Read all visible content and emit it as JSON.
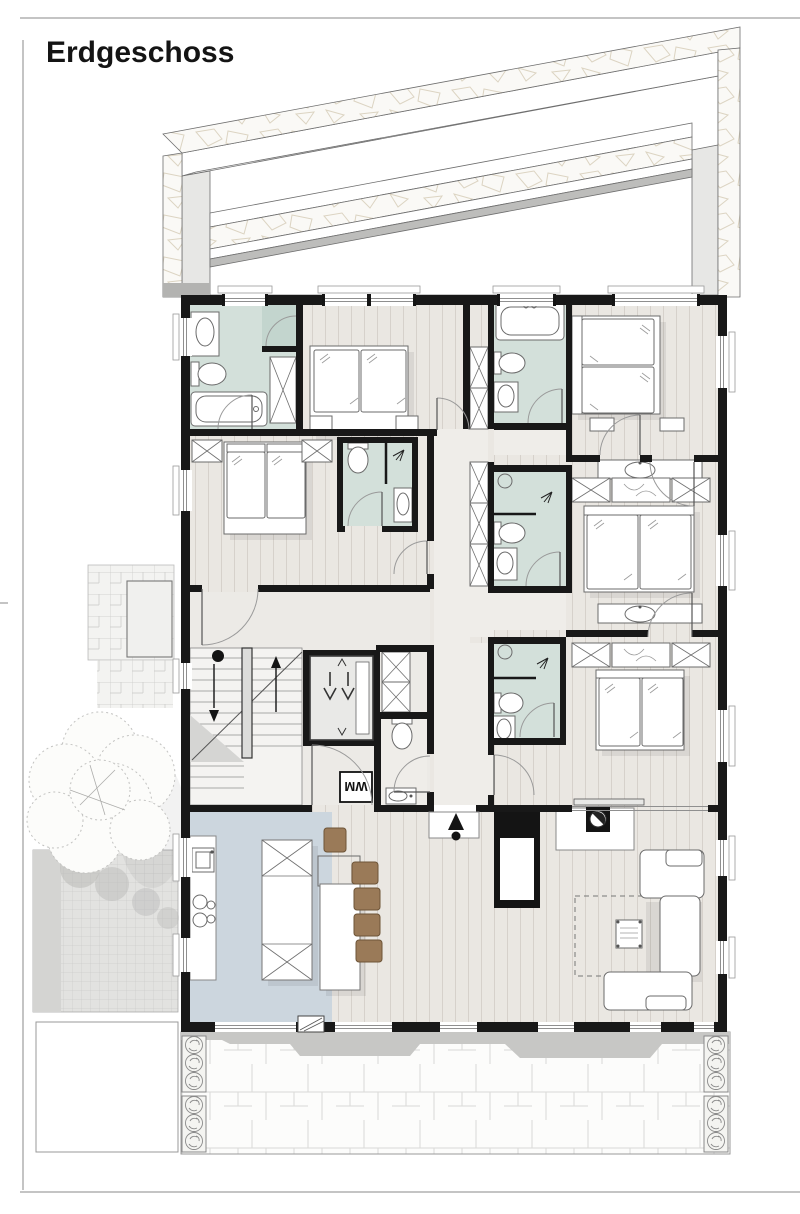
{
  "page": {
    "title": "Erdgeschoss"
  },
  "labels": {
    "washing_machine": "WM"
  },
  "colors": {
    "wall": "#181818",
    "floor_wood": "#eae7e2",
    "floor_hall": "#eceae6",
    "floor_corridor": "#efede9",
    "bathroom": "#d3e0da",
    "shower": "#c3d5ce",
    "kitchen": "#ccd6de",
    "chair_wood": "#9a7a58",
    "stone_bg": "#faf9f6",
    "paving_gray": "#e2e2e0",
    "shadow_band": "#c7c7c5"
  },
  "icons": {
    "entrance": "entry-arrow",
    "stair_up": "arrow-up",
    "stair_down": "arrow-down",
    "elevator": "double-v-arrows",
    "stove": "half-filled-circle",
    "plants": "planter-circles"
  }
}
